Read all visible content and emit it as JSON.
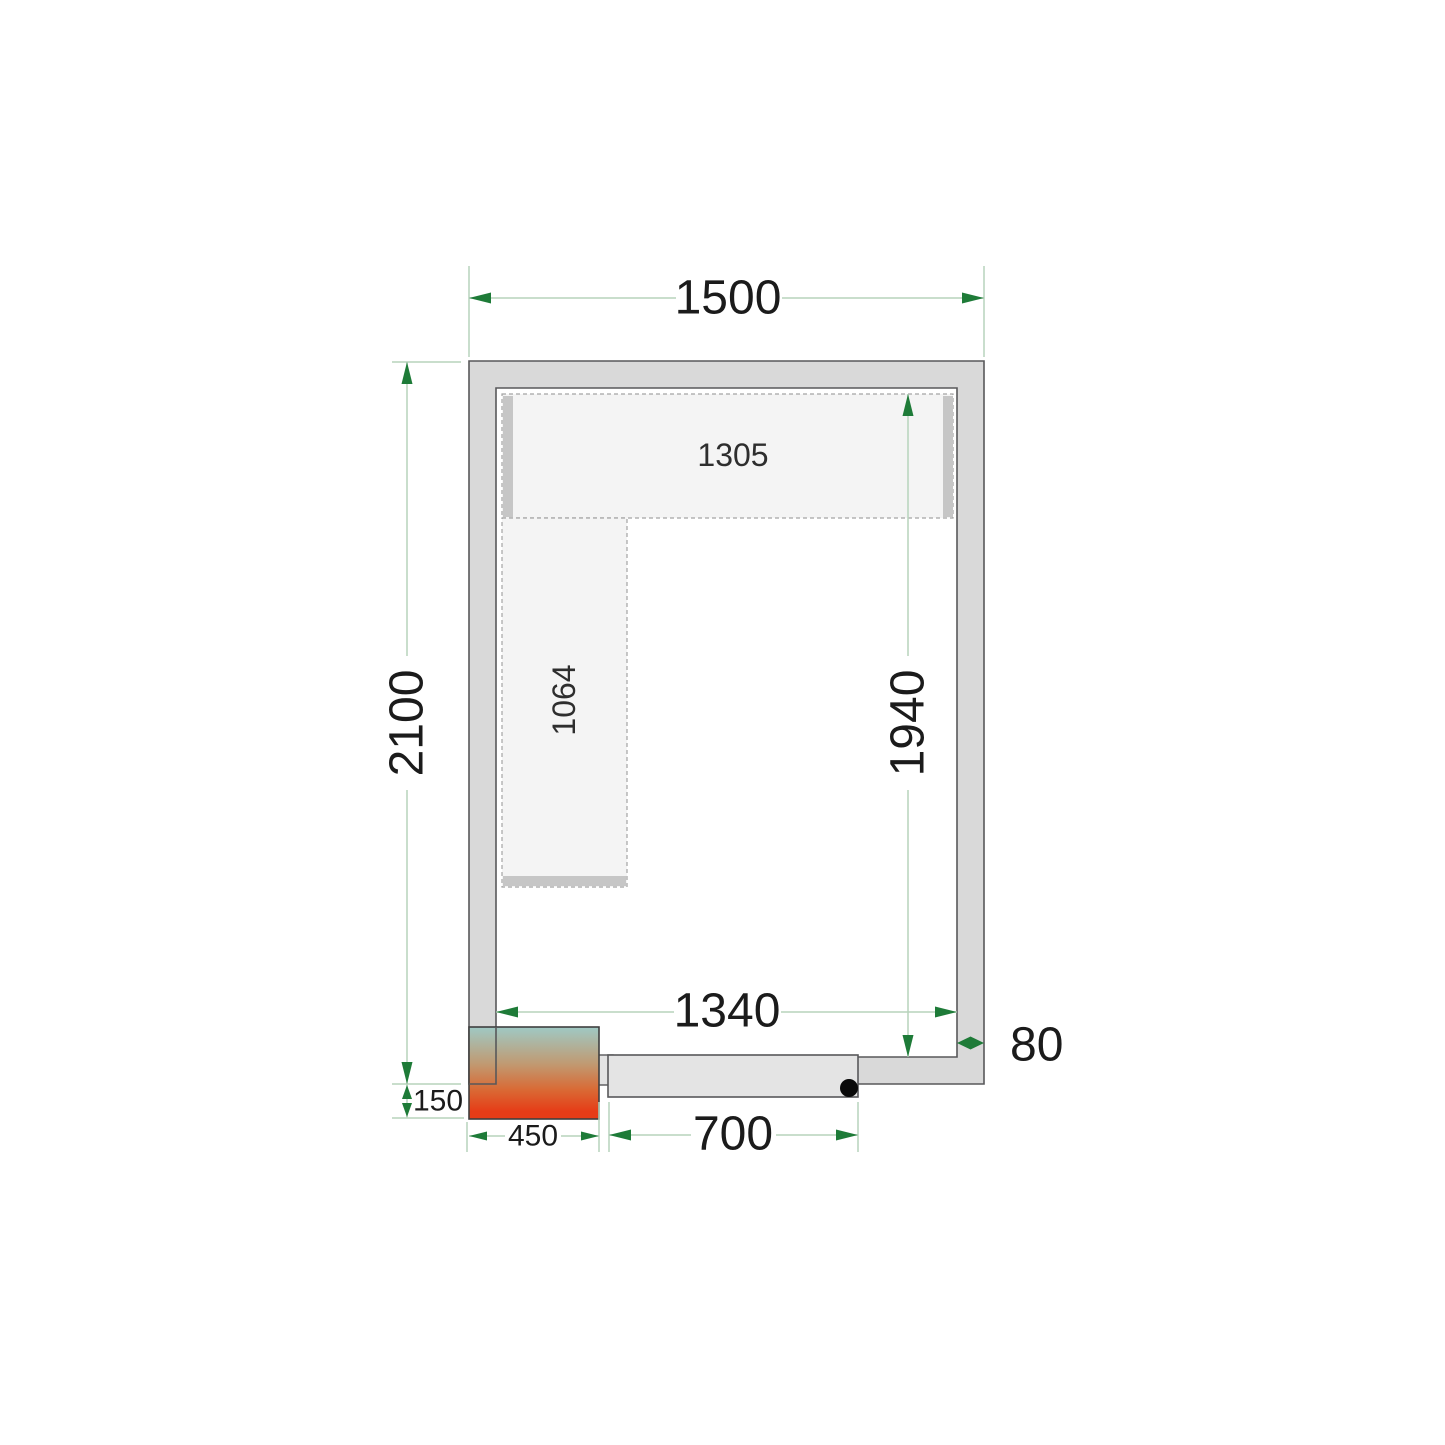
{
  "diagram": {
    "labels": {
      "outer_width": "1500",
      "outer_height": "2100",
      "inner_width": "1340",
      "inner_height": "1940",
      "wall_thickness": "80",
      "cooling_unit_depth": "150",
      "cooling_unit_width": "450",
      "door_width": "700",
      "top_shelf_length": "1305",
      "side_shelf_length": "1064"
    },
    "colors": {
      "background": "#ffffff",
      "dim_line": "#b7d3bc",
      "arrow": "#1e7b38",
      "text": "#1b1b1b",
      "wall_fill": "#d9d9d9",
      "wall_stroke": "#58585a",
      "shelf_fill": "#f4f4f4",
      "shelf_dash": "#a3a3a3",
      "shelf_bar": "#c6c6c6",
      "door_fill": "#e4e4e4",
      "hinge_dot": "#0a0a0a",
      "grad_top": "#9fc9c4",
      "grad_mid": "#c09a72",
      "grad_low": "#d96a35",
      "grad_bottom": "#e63c17"
    }
  }
}
